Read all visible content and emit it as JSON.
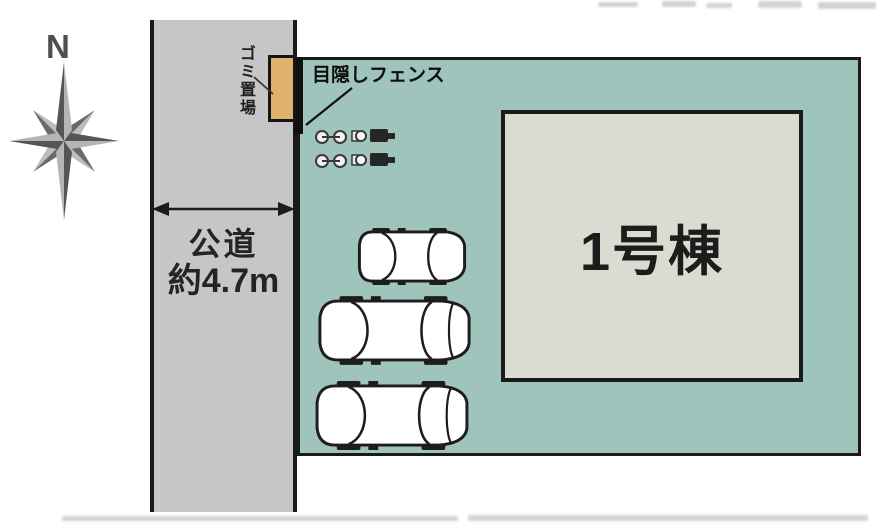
{
  "compass": {
    "label": "N"
  },
  "road": {
    "name": "公道",
    "width": "約4.7m"
  },
  "site": {
    "building": {
      "label": "1号棟"
    },
    "fence": {
      "label": "目隠しフェンス"
    },
    "garbage": {
      "label": "ゴミ置場"
    },
    "parking": {
      "cars": 3,
      "bicycles": 2
    }
  },
  "colors": {
    "site_fill": "#9ec4bb",
    "road_fill": "#c6c6c8",
    "building_fill": "#dcdbd2",
    "garbage_fill": "#dfb16c",
    "line": "#1a1a1a"
  }
}
